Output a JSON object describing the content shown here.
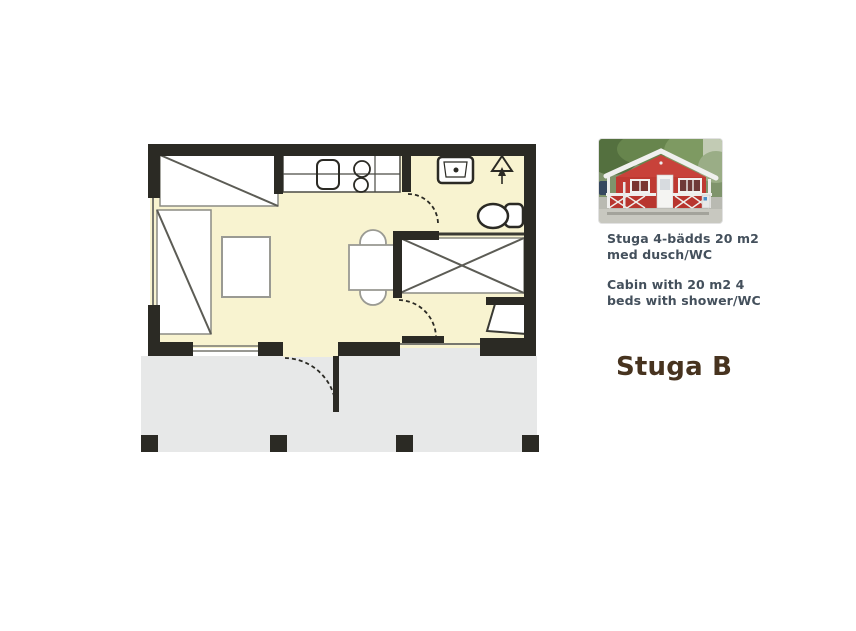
{
  "title": "Stuga B",
  "info": {
    "sv": [
      "Stuga 4-bädds 20 m2",
      "med dusch/WC"
    ],
    "en": [
      "Cabin with 20 m2 4",
      "beds with shower/WC"
    ]
  },
  "photo": {
    "subject": "red wooden cabin with white trim, porch railing and gable roof"
  },
  "floor_plan": {
    "type": "cabin floor plan, top view, 4 beds",
    "fixtures": [
      "bunk-bed-top-left",
      "single-bed-left",
      "small-table",
      "kitchen-counter",
      "kitchen-sink",
      "stove-burners",
      "washbasin",
      "entrance-arrow-symbol",
      "toilet",
      "dining-table-with-chairs",
      "bunk-bed-right",
      "shower-bench",
      "entrance-door",
      "interior-doors",
      "porch-with-posts"
    ]
  },
  "colors": {
    "background": "#ffffff",
    "floor": "#f8f3d0",
    "porch": "#e7e8e8",
    "wall": "#2b2a24",
    "furniture_fill": "#ffffff",
    "furniture_stroke": "#8b8b84",
    "window_line": "#77776f",
    "body_text": "#44505c",
    "title_text": "#47331f",
    "cabin_red": "#bf3a32"
  }
}
